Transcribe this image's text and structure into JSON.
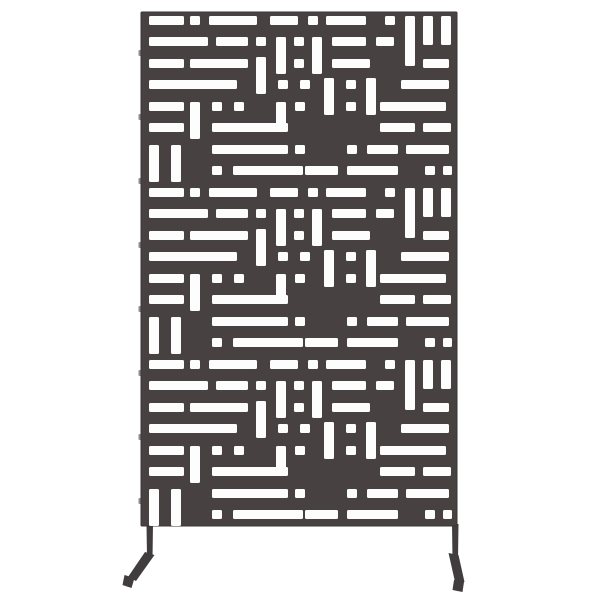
{
  "scene": {
    "width": 600,
    "height": 600,
    "background_color": "#ffffff",
    "subject": "metal privacy screen product photo"
  },
  "colors": {
    "panel_dark": "#474142",
    "panel_edge": "#3a3536",
    "cutout_white": "#fdfdfd",
    "leg_dark": "#413c3d",
    "tab_gray": "#918d8e"
  },
  "panel": {
    "x": 141,
    "y": 12,
    "width": 316,
    "height": 514,
    "inner_offset_x": 7,
    "corner_radius": 1
  },
  "pattern": {
    "band_height": 172,
    "band_count": 3,
    "slot_corner_radius": 1.5,
    "rects": [
      [
        1,
        4,
        35,
        9
      ],
      [
        42,
        4,
        10,
        9
      ],
      [
        61,
        4,
        48,
        9
      ],
      [
        122,
        4,
        28,
        9
      ],
      [
        160,
        4,
        10,
        9
      ],
      [
        178,
        4,
        40,
        9
      ],
      [
        237,
        4,
        10,
        9
      ],
      [
        257,
        4,
        10,
        50
      ],
      [
        275,
        4,
        10,
        29
      ],
      [
        293,
        4,
        10,
        29
      ],
      [
        1,
        25,
        59,
        9
      ],
      [
        68,
        25,
        32,
        9
      ],
      [
        108,
        25,
        10,
        9
      ],
      [
        146,
        25,
        10,
        9
      ],
      [
        184,
        25,
        34,
        9
      ],
      [
        228,
        25,
        18,
        9
      ],
      [
        128,
        25,
        10,
        37
      ],
      [
        164,
        25,
        10,
        37
      ],
      [
        1,
        47,
        35,
        9
      ],
      [
        42,
        47,
        58,
        9
      ],
      [
        146,
        47,
        10,
        9
      ],
      [
        184,
        47,
        38,
        9
      ],
      [
        275,
        47,
        26,
        9
      ],
      [
        108,
        45,
        10,
        37
      ],
      [
        1,
        68,
        88,
        9
      ],
      [
        130,
        68,
        10,
        9
      ],
      [
        152,
        68,
        10,
        9
      ],
      [
        198,
        68,
        10,
        9
      ],
      [
        253,
        68,
        48,
        9
      ],
      [
        176,
        66,
        10,
        37
      ],
      [
        218,
        66,
        10,
        37
      ],
      [
        1,
        90,
        35,
        9
      ],
      [
        64,
        90,
        10,
        9
      ],
      [
        86,
        90,
        10,
        9
      ],
      [
        147,
        90,
        10,
        9
      ],
      [
        198,
        90,
        10,
        9
      ],
      [
        232,
        90,
        66,
        9
      ],
      [
        42,
        90,
        10,
        37
      ],
      [
        128,
        90,
        10,
        28
      ],
      [
        1,
        111,
        35,
        9
      ],
      [
        64,
        111,
        76,
        9
      ],
      [
        232,
        111,
        35,
        9
      ],
      [
        275,
        111,
        28,
        9
      ],
      [
        64,
        133,
        76,
        9
      ],
      [
        147,
        133,
        10,
        9
      ],
      [
        199,
        133,
        10,
        9
      ],
      [
        219,
        133,
        31,
        9
      ],
      [
        258,
        133,
        43,
        9
      ],
      [
        1,
        133,
        10,
        37
      ],
      [
        23,
        133,
        10,
        37
      ],
      [
        64,
        154,
        10,
        9
      ],
      [
        85,
        154,
        70,
        9
      ],
      [
        157,
        154,
        33,
        9
      ],
      [
        199,
        154,
        51,
        9
      ],
      [
        277,
        154,
        10,
        9
      ],
      [
        295,
        154,
        9,
        9
      ]
    ]
  },
  "edge_tabs": {
    "x_offset": -2.5,
    "width": 3,
    "height": 6,
    "y_positions": [
      50,
      114,
      178,
      242,
      306,
      370,
      434,
      498
    ]
  },
  "legs": {
    "left": {
      "post": [
        [
          146.5,
          524
        ],
        [
          153,
          524
        ],
        [
          152.5,
          558
        ],
        [
          147,
          558
        ]
      ],
      "foot": [
        [
          145,
          552
        ],
        [
          154.5,
          555
        ],
        [
          136,
          581
        ],
        [
          128,
          577
        ]
      ],
      "tip": [
        [
          124.5,
          575
        ],
        [
          134.5,
          578
        ],
        [
          131.5,
          588
        ],
        [
          122.5,
          585
        ]
      ]
    },
    "right": {
      "post": [
        [
          452,
          524
        ],
        [
          458.5,
          524
        ],
        [
          458,
          558
        ],
        [
          452.5,
          558
        ]
      ],
      "foot": [
        [
          448.5,
          553
        ],
        [
          458.5,
          555
        ],
        [
          464.5,
          582
        ],
        [
          455.5,
          584
        ]
      ],
      "tip": [
        [
          454,
          580
        ],
        [
          464,
          582
        ],
        [
          462.5,
          592
        ],
        [
          452.5,
          590
        ]
      ]
    }
  }
}
